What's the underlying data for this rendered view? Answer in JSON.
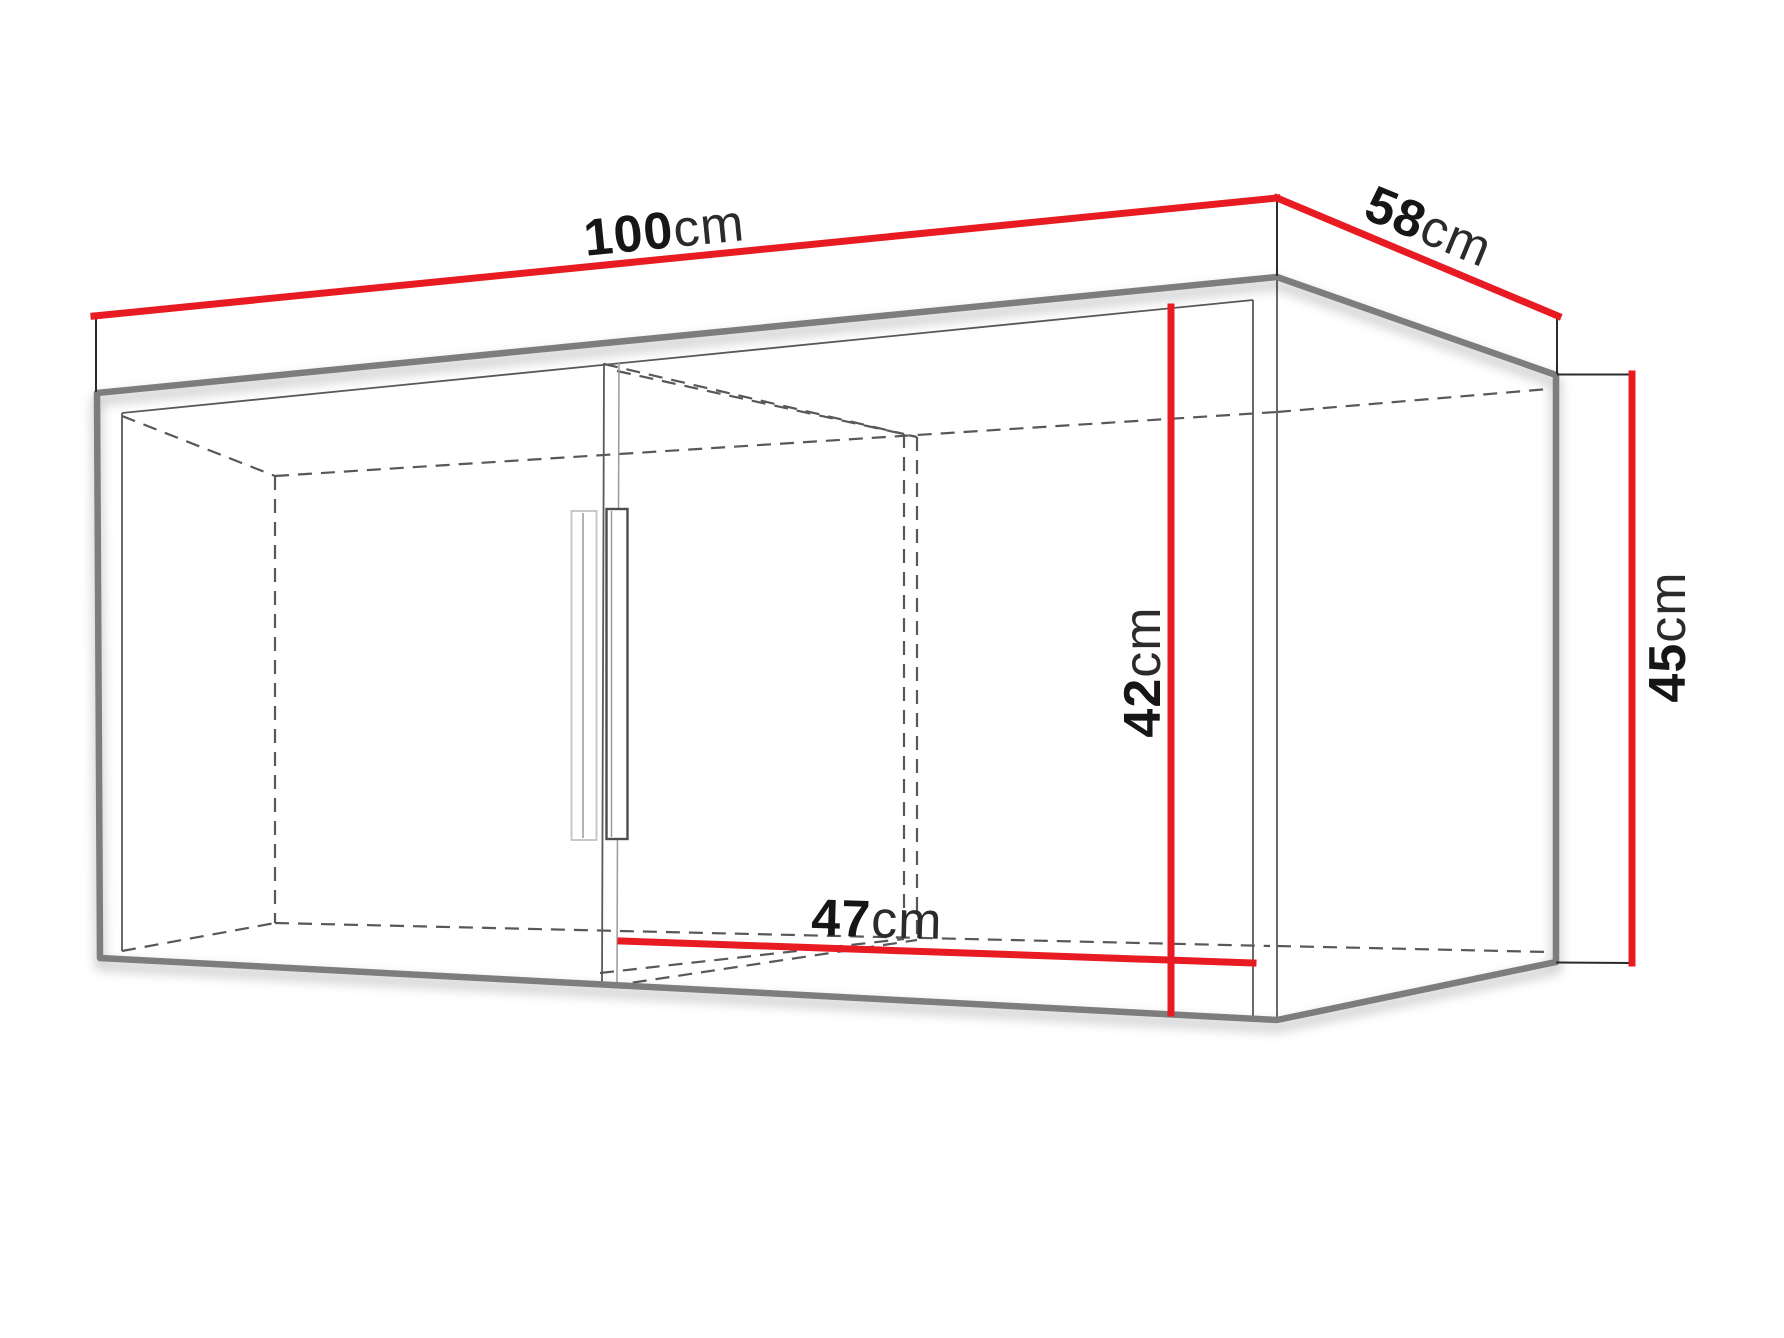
{
  "diagram": {
    "type": "furniture-dimension-diagram",
    "subject": "wall-cabinet-with-two-doors",
    "unit": "cm",
    "dimensions": {
      "width": {
        "value": "100",
        "unit": "cm",
        "location": "top-front-edge"
      },
      "depth": {
        "value": "58",
        "unit": "cm",
        "location": "top-right-edge"
      },
      "height": {
        "value": "45",
        "unit": "cm",
        "location": "right-back-edge"
      },
      "inner_height": {
        "value": "42",
        "unit": "cm",
        "location": "front-interior"
      },
      "inner_width": {
        "value": "47",
        "unit": "cm",
        "location": "bottom-interior-right-compartment"
      }
    },
    "colors": {
      "dimension_red": "#e81b23",
      "outline_gray": "#7d7d7d",
      "dash_gray": "#58585a",
      "label_black": "#161616",
      "background": "#ffffff"
    }
  }
}
